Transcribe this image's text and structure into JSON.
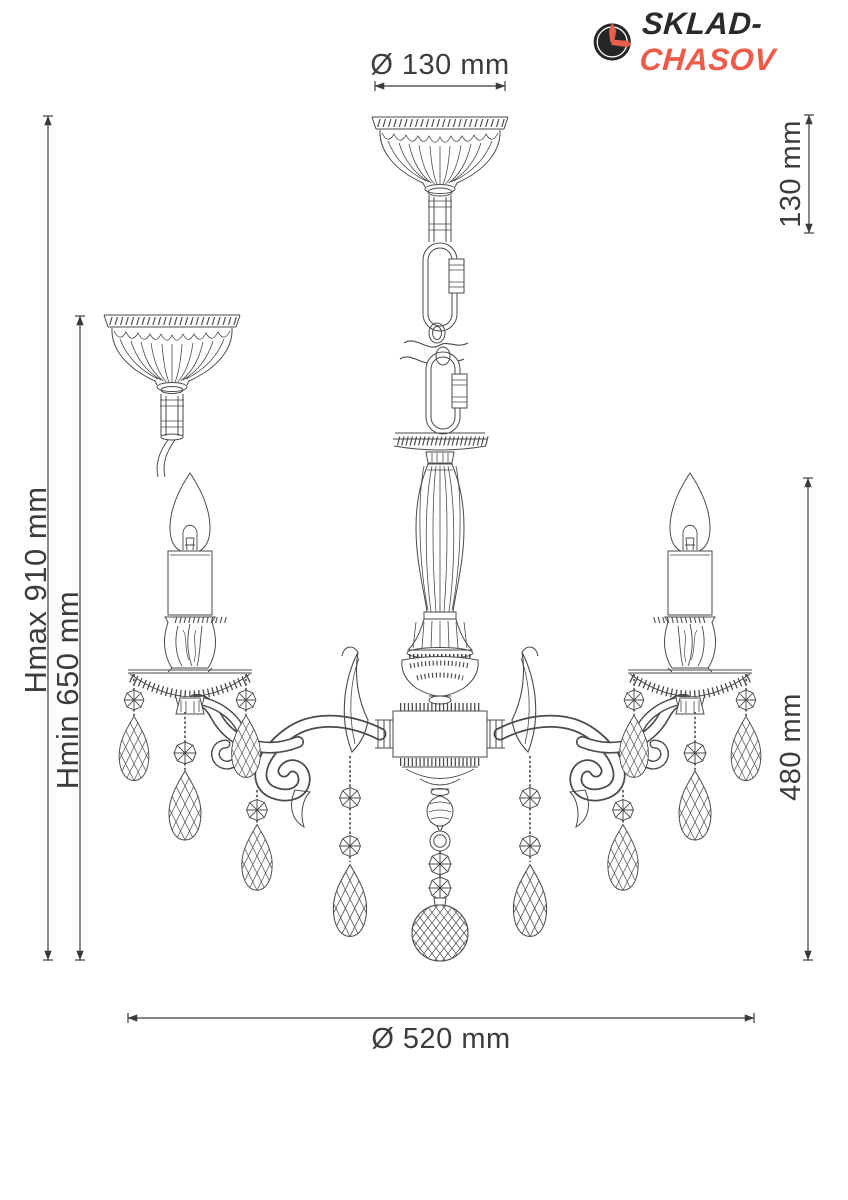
{
  "logo": {
    "brand": "SKLAD",
    "hyphen": "-",
    "brand2": "CHASOV"
  },
  "annotations": {
    "top_diameter": "Ø 130 mm",
    "canopy_height": "130 mm",
    "hmax": "Hmax 910 mm",
    "hmin": "Hmin 650 mm",
    "fixture_height": "480 mm",
    "fixture_diameter": "Ø 520 mm"
  },
  "colors": {
    "accent_red": "#ee5b48",
    "logo_ink": "#2b2a29",
    "drawing_line": "#4a4a4a",
    "dimension_text": "#3c3c3c",
    "background": "#ffffff"
  }
}
